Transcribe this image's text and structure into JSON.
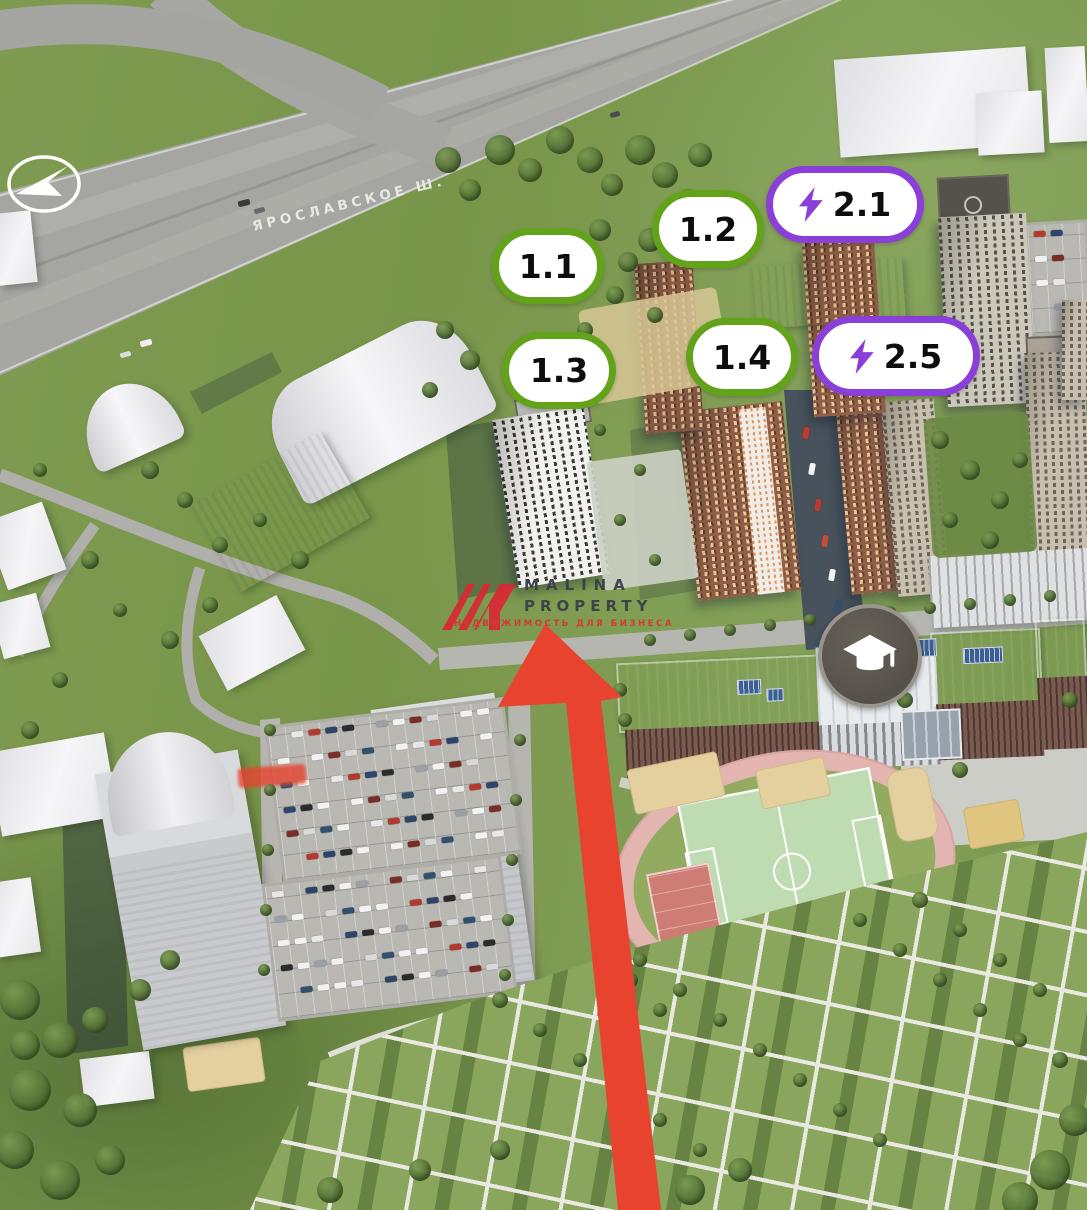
{
  "title": "Residential complex aerial masterplan render",
  "road_label": "ЯРОСЛАВСКОЕ Ш.",
  "badges": [
    {
      "id": "1.1",
      "label": "1.1",
      "variant": "green",
      "has_bolt": false
    },
    {
      "id": "1.2",
      "label": "1.2",
      "variant": "green",
      "has_bolt": false
    },
    {
      "id": "2.1",
      "label": "2.1",
      "variant": "purple",
      "has_bolt": true
    },
    {
      "id": "1.3",
      "label": "1.3",
      "variant": "green",
      "has_bolt": false
    },
    {
      "id": "1.4",
      "label": "1.4",
      "variant": "green",
      "has_bolt": false
    },
    {
      "id": "2.5",
      "label": "2.5",
      "variant": "purple",
      "has_bolt": true
    }
  ],
  "watermark": {
    "brand_top": "MALINA",
    "brand_bottom": "PROPERTY",
    "tagline": "НЕДВИЖИМОСТЬ ДЛЯ БИЗНЕСА"
  },
  "icons": {
    "navigation": "navigation-arrow-icon",
    "lightning": "lightning-bolt-icon",
    "education": "graduation-cap-icon",
    "pointer": "red-arrow-pointer"
  },
  "colors": {
    "badge_green": "#63a31c",
    "badge_purple": "#8a3fd8",
    "bolt_purple": "#8a3fd8",
    "arrow_red": "#e8432e",
    "brand_red": "#d62b35",
    "brand_dark": "#3a4149",
    "tagline_red": "#d63731",
    "school_roof": "#ae5048",
    "pitch_green": "#bedbb2",
    "track_pink": "#e3b5b1"
  }
}
